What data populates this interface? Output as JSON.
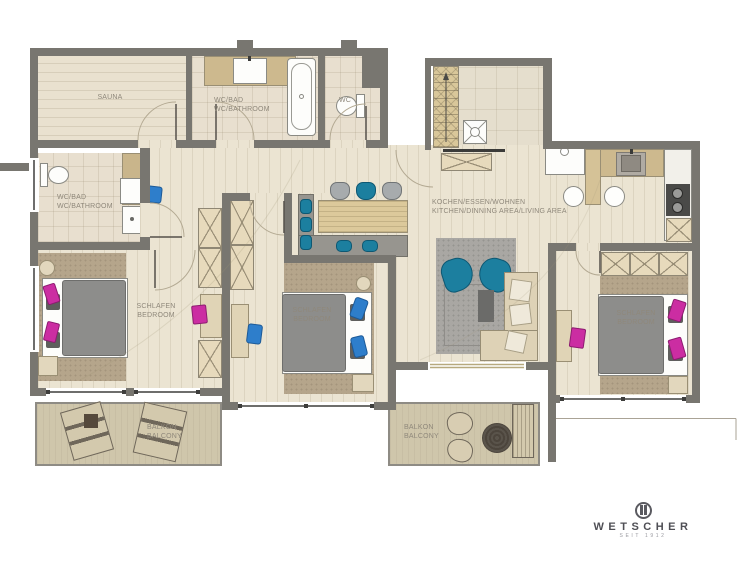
{
  "plan_title": "apartment-floor-plan",
  "rooms": {
    "sauna": {
      "label": "SAUNA"
    },
    "bathroom_top": {
      "line1": "WC/BAD",
      "line2": "WC/BATHROOM"
    },
    "wc": {
      "label": "WC"
    },
    "bathroom_left": {
      "line1": "WC/BAD",
      "line2": "WC/BATHROOM"
    },
    "kitchen_living": {
      "line1": "KOCHEN/ESSEN/WOHNEN",
      "line2": "KITCHEN/DINNING AREA/LIVING AREA"
    },
    "bedroom_left": {
      "line1": "SCHLAFEN",
      "line2": "BEDROOM"
    },
    "bedroom_middle": {
      "line1": "SCHLAFEN",
      "line2": "BEDROOM"
    },
    "bedroom_right": {
      "line1": "SCHLAFEN",
      "line2": "BEDROOM"
    },
    "balcony_left": {
      "line1": "BALKON",
      "line2": "BALCONY"
    },
    "balcony_right": {
      "line1": "BALKON",
      "line2": "BALCONY"
    }
  },
  "logo": {
    "brand": "WETSCHER",
    "tagline": "SEIT 1912"
  },
  "colors": {
    "wall": "#787670",
    "floor": "#ebe4d2",
    "accent_teal": "#1c7f9f",
    "accent_blue": "#2e7ecb",
    "accent_magenta": "#cb2da2",
    "furniture_tan": "#d9c597",
    "rug_gray": "#a9a7a3",
    "duvet_gray": "#8d8d8b",
    "balcony_floor": "#cfc6ab",
    "label_text": "#8f887b"
  }
}
